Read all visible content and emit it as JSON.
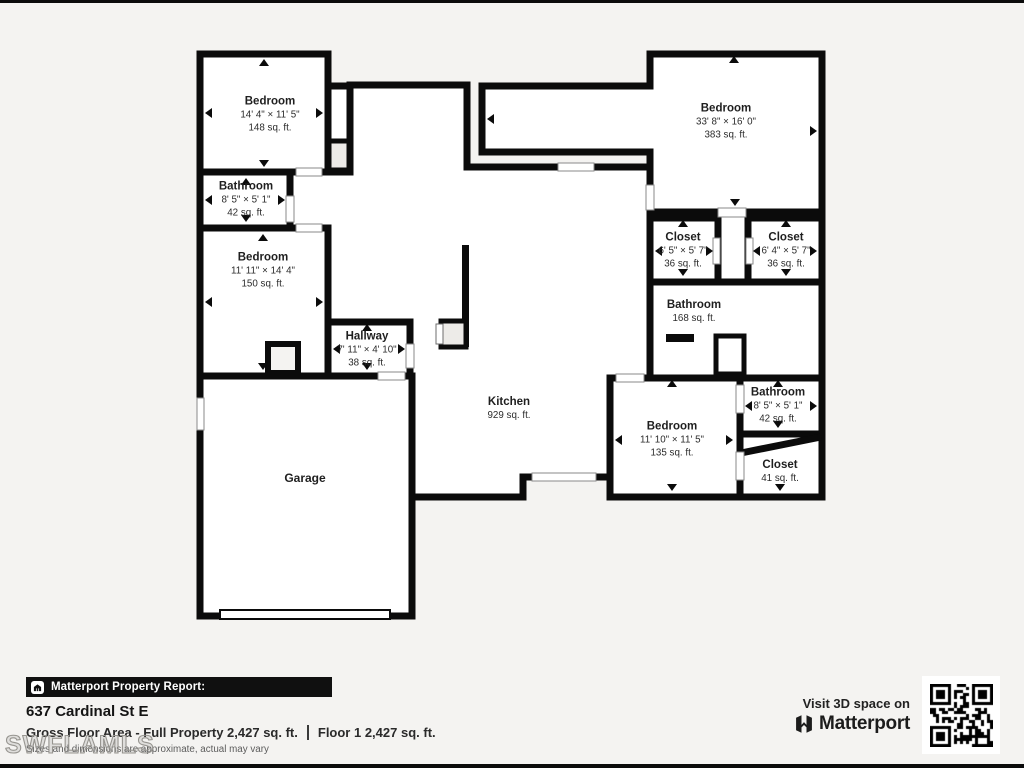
{
  "colors": {
    "background": "#f4f3f1",
    "wall": "#0b0b0b",
    "room_fill": "#ffffff",
    "closet_fill": "#edebe8",
    "report_bar_bg": "#101010",
    "watermark_gray": "#979590"
  },
  "rooms": [
    {
      "id": "bedroom-top-left",
      "name": "Bedroom",
      "dims": "14' 4\" × 11' 5\"",
      "area": "148 sq. ft."
    },
    {
      "id": "bathroom-top-left",
      "name": "Bathroom",
      "dims": "8' 5\" × 5' 1\"",
      "area": "42 sq. ft."
    },
    {
      "id": "bedroom-mid-left",
      "name": "Bedroom",
      "dims": "11' 11\" × 14' 4\"",
      "area": "150 sq. ft."
    },
    {
      "id": "hallway",
      "name": "Hallway",
      "dims": "7' 11\" × 4' 10\"",
      "area": "38 sq. ft."
    },
    {
      "id": "garage",
      "name": "Garage"
    },
    {
      "id": "kitchen",
      "name": "Kitchen",
      "area": "929 sq. ft."
    },
    {
      "id": "bedroom-top-right",
      "name": "Bedroom",
      "dims": "33' 8\" × 16' 0\"",
      "area": "383 sq. ft."
    },
    {
      "id": "closet-left",
      "name": "Closet",
      "dims": "6' 5\" × 5' 7\"",
      "area": "36 sq. ft."
    },
    {
      "id": "closet-right",
      "name": "Closet",
      "dims": "6' 4\" × 5' 7\"",
      "area": "36 sq. ft."
    },
    {
      "id": "bathroom-center",
      "name": "Bathroom",
      "area": "168 sq. ft."
    },
    {
      "id": "bedroom-bottom-right",
      "name": "Bedroom",
      "dims": "11' 10\" × 11' 5\"",
      "area": "135 sq. ft."
    },
    {
      "id": "bathroom-bottom-right",
      "name": "Bathroom",
      "dims": "8' 5\" × 5' 1\"",
      "area": "42 sq. ft."
    },
    {
      "id": "closet-bottom-right",
      "name": "Closet",
      "area": "41 sq. ft."
    }
  ],
  "footer": {
    "report_bar": "Matterport Property Report:",
    "address": "637 Cardinal St E",
    "gross_label": "Gross Floor Area - Full Property 2,427 sq. ft.",
    "floor_label": "Floor 1 2,427 sq. ft.",
    "disclaimer": "Sizes and dimensions are approximate, actual may vary",
    "watermark": "SWFLAMLS",
    "visit_text": "Visit 3D space on",
    "brand": "Matterport"
  }
}
